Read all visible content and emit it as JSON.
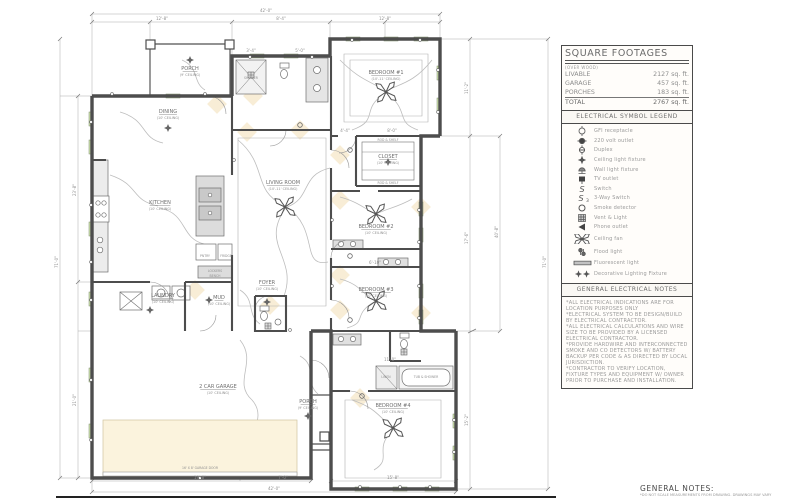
{
  "colors": {
    "wall": "#4d4d4d",
    "thin": "#8f8f8f",
    "window": "#cfe3ae",
    "glow": "#f6e8cc",
    "wire": "#bdbdbd",
    "dimtext": "#8f8f8f"
  },
  "panel": {
    "square_footages": {
      "title": "SQUARE FOOTAGES",
      "subtitle": "(OVER WOOD)",
      "rows": [
        {
          "label": "LIVABLE",
          "value": "2127 sq. ft."
        },
        {
          "label": "GARAGE",
          "value": "457 sq. ft."
        },
        {
          "label": "PORCHES",
          "value": "183 sq. ft."
        },
        {
          "label": "TOTAL",
          "value": "2767 sq. ft."
        }
      ]
    },
    "legend": {
      "title": "ELECTRICAL SYMBOL LEGEND",
      "items": [
        {
          "symbol": "gfi",
          "label": "GFI receptacle"
        },
        {
          "symbol": "v220",
          "label": "220 volt outlet"
        },
        {
          "symbol": "duplex",
          "label": "Duplex"
        },
        {
          "symbol": "ceil-light",
          "label": "Ceiling light fixture"
        },
        {
          "symbol": "wall-light",
          "label": "Wall light fixture"
        },
        {
          "symbol": "tv",
          "label": "TV outlet"
        },
        {
          "symbol": "switch",
          "label": "Switch"
        },
        {
          "symbol": "switch3",
          "label": "3-Way Switch"
        },
        {
          "symbol": "smoke",
          "label": "Smoke detector"
        },
        {
          "symbol": "vent",
          "label": "Vent & Light"
        },
        {
          "symbol": "phone",
          "label": "Phone outlet"
        },
        {
          "symbol": "fan",
          "label": "Ceiling fan",
          "tall": true
        },
        {
          "symbol": "flood",
          "label": "Flood light",
          "tall": true
        },
        {
          "symbol": "fluor",
          "label": "Fluorescent light"
        },
        {
          "symbol": "decor",
          "label": "Decorative Lighting Fixture",
          "tall": true
        }
      ]
    },
    "electrical_notes": {
      "title": "GENERAL ELECTRICAL NOTES",
      "lines": [
        "*ALL ELECTRICAL INDICATIONS ARE FOR LOCATION PURPOSES ONLY",
        "*ELECTRICAL SYSTEM TO BE DESIGN/BUILD BY ELECTRICAL CONTRACTOR.",
        "*ALL ELECTRICAL CALCULATIONS AND WIRE SIZE TO BE PROVIDED BY A LICENSED ELECTRICAL CONTRACTOR.",
        "*PROVIDE HARDWIRE AND INTERCONNECTED SMOKE AND CO DETECTORS W/ BATTERY BACKUP PER CODE & AS DIRECTED BY LOCAL JURISDICTION.",
        "*CONTRACTOR TO VERIFY LOCATION, FIXTURE TYPES AND EQUIPMENT W/ OWNER PRIOR TO PURCHASE AND INSTALLATION."
      ]
    }
  },
  "general_notes": {
    "title": "GENERAL NOTES:",
    "line": "*DO NOT SCALE MEASUREMENTS FROM DRAWING. DRAWINGS MAY VARY"
  },
  "plan": {
    "rooms": [
      {
        "name": "PORCH",
        "sub": "(9' CEILING)",
        "x": 190,
        "y": 70
      },
      {
        "name": "DINING",
        "sub": "(10' CEILING)",
        "x": 168,
        "y": 113
      },
      {
        "name": "KITCHEN",
        "sub": "(10' CEILING)",
        "x": 160,
        "y": 204
      },
      {
        "name": "LIVING ROOM",
        "sub": "(10'-11' CEILING)",
        "x": 283,
        "y": 184
      },
      {
        "name": "BEDROOM #1",
        "sub": "(10'-11' CEILING)",
        "x": 386,
        "y": 74
      },
      {
        "name": "CLOSET",
        "sub": "(10' CEILING)",
        "x": 388,
        "y": 158
      },
      {
        "name": "BEDROOM #2",
        "sub": "(10' CEILING)",
        "x": 376,
        "y": 228
      },
      {
        "name": "BEDROOM #3",
        "sub": "(10' CEILING)",
        "x": 376,
        "y": 291
      },
      {
        "name": "LAUNDRY",
        "sub": "(10' CEILING)",
        "x": 163,
        "y": 297
      },
      {
        "name": "MUD",
        "sub": "(10' CEILING)",
        "x": 219,
        "y": 299
      },
      {
        "name": "FOYER",
        "sub": "(10' CEILING)",
        "x": 267,
        "y": 284
      },
      {
        "name": "2 CAR GARAGE",
        "sub": "(10' CEILING)",
        "x": 218,
        "y": 388
      },
      {
        "name": "PORCH",
        "sub": "(9' CEILING)",
        "x": 308,
        "y": 403
      },
      {
        "name": "BEDROOM #4",
        "sub": "(10' CEILING)",
        "x": 393,
        "y": 407
      }
    ],
    "fixture_labels": [
      {
        "t": "SHOWER",
        "x": 251,
        "y": 79
      },
      {
        "t": "FRIDGE",
        "x": 226,
        "y": 257
      },
      {
        "t": "PNTRY",
        "x": 205,
        "y": 257
      },
      {
        "t": "LOCKERS",
        "x": 215,
        "y": 272
      },
      {
        "t": "BENCH",
        "x": 215,
        "y": 277
      },
      {
        "t": "TUB & SHOWER",
        "x": 426,
        "y": 378
      },
      {
        "t": "LINEN",
        "x": 386,
        "y": 378
      },
      {
        "t": "ROD & SHELF",
        "x": 388,
        "y": 141
      },
      {
        "t": "ROD & SHELF",
        "x": 388,
        "y": 184
      },
      {
        "t": "16' X 8' GARAGE DOOR",
        "x": 200,
        "y": 469
      }
    ],
    "dims": [
      {
        "t": "42'-0\"",
        "x": 266,
        "y": 12
      },
      {
        "t": "12'-8\"",
        "x": 162,
        "y": 20
      },
      {
        "t": "8'-4\"",
        "x": 281,
        "y": 20
      },
      {
        "t": "12'-8\"",
        "x": 385,
        "y": 20
      },
      {
        "t": "3'-4\"",
        "x": 251,
        "y": 52
      },
      {
        "t": "5'-0\"",
        "x": 300,
        "y": 52
      },
      {
        "t": "4'-4\"",
        "x": 345,
        "y": 132
      },
      {
        "t": "8'-0\"",
        "x": 392,
        "y": 132
      },
      {
        "t": "6'-10\"",
        "x": 375,
        "y": 264
      },
      {
        "t": "11'-0\"",
        "x": 390,
        "y": 361
      },
      {
        "t": "19'-8\"",
        "x": 200,
        "y": 479
      },
      {
        "t": "7'-0\"",
        "x": 283,
        "y": 479
      },
      {
        "t": "15'-8\"",
        "x": 393,
        "y": 479
      },
      {
        "t": "42'-0\"",
        "x": 274,
        "y": 490
      },
      {
        "t": "23'-8\"",
        "x": 76,
        "y": 190,
        "r": 1
      },
      {
        "t": "21'-0\"",
        "x": 76,
        "y": 400,
        "r": 1
      },
      {
        "t": "71'-0\"",
        "x": 58,
        "y": 262,
        "r": 1
      },
      {
        "t": "11'-2\"",
        "x": 468,
        "y": 88,
        "r": 1
      },
      {
        "t": "17'-6\"",
        "x": 468,
        "y": 238,
        "r": 1
      },
      {
        "t": "15'-2\"",
        "x": 468,
        "y": 420,
        "r": 1
      },
      {
        "t": "40'-8\"",
        "x": 498,
        "y": 232,
        "r": 1
      },
      {
        "t": "71'-0\"",
        "x": 546,
        "y": 262,
        "r": 1
      }
    ],
    "fans": [
      [
        386,
        92
      ],
      [
        285,
        207
      ],
      [
        376,
        214
      ],
      [
        376,
        301
      ],
      [
        393,
        428
      ]
    ],
    "outlets": [
      [
        112,
        94
      ],
      [
        205,
        94
      ],
      [
        250,
        57
      ],
      [
        312,
        57
      ],
      [
        352,
        40
      ],
      [
        420,
        40
      ],
      [
        438,
        70
      ],
      [
        438,
        112
      ],
      [
        419,
        210
      ],
      [
        419,
        242
      ],
      [
        419,
        286
      ],
      [
        419,
        318
      ],
      [
        454,
        420
      ],
      [
        454,
        452
      ],
      [
        360,
        487
      ],
      [
        400,
        487
      ],
      [
        430,
        487
      ],
      [
        91,
        122
      ],
      [
        91,
        205
      ],
      [
        91,
        262
      ],
      [
        91,
        300
      ],
      [
        91,
        380
      ],
      [
        91,
        440
      ],
      [
        234,
        160
      ],
      [
        332,
        220
      ],
      [
        332,
        286
      ],
      [
        290,
        330
      ],
      [
        200,
        478
      ]
    ],
    "smokes": [
      [
        350,
        150
      ],
      [
        350,
        256
      ],
      [
        350,
        320
      ],
      [
        300,
        125
      ],
      [
        362,
        396
      ]
    ],
    "clights": [
      [
        168,
        128
      ],
      [
        267,
        302
      ],
      [
        388,
        162
      ],
      [
        209,
        300
      ],
      [
        150,
        310
      ],
      [
        190,
        60
      ],
      [
        308,
        416
      ]
    ],
    "vents": [
      [
        251,
        75
      ],
      [
        268,
        326
      ],
      [
        404,
        352
      ]
    ],
    "windows": [
      [
        166,
        94,
        14,
        4
      ],
      [
        250,
        54,
        14,
        4
      ],
      [
        284,
        54,
        14,
        4
      ],
      [
        346,
        37,
        14,
        4
      ],
      [
        384,
        37,
        14,
        4
      ],
      [
        414,
        37,
        14,
        4
      ],
      [
        355,
        487,
        14,
        4
      ],
      [
        393,
        487,
        14,
        4
      ],
      [
        425,
        487,
        14,
        4
      ],
      [
        89,
        112,
        4,
        14
      ],
      [
        89,
        140,
        4,
        14
      ],
      [
        89,
        222,
        4,
        14
      ],
      [
        89,
        292,
        4,
        14
      ],
      [
        89,
        368,
        4,
        14
      ],
      [
        89,
        424,
        4,
        14
      ],
      [
        437,
        66,
        4,
        14
      ],
      [
        437,
        98,
        4,
        14
      ],
      [
        419,
        202,
        4,
        14
      ],
      [
        419,
        228,
        4,
        14
      ],
      [
        419,
        284,
        4,
        14
      ],
      [
        419,
        310,
        4,
        14
      ],
      [
        453,
        414,
        4,
        14
      ],
      [
        453,
        446,
        4,
        14
      ]
    ],
    "glows": [
      [
        217,
        104
      ],
      [
        247,
        132
      ],
      [
        300,
        130
      ],
      [
        340,
        155
      ],
      [
        340,
        200
      ],
      [
        340,
        275
      ],
      [
        360,
        398
      ],
      [
        270,
        305
      ],
      [
        195,
        290
      ],
      [
        421,
        207
      ],
      [
        421,
        313
      ],
      [
        253,
        96
      ],
      [
        340,
        310
      ]
    ]
  }
}
